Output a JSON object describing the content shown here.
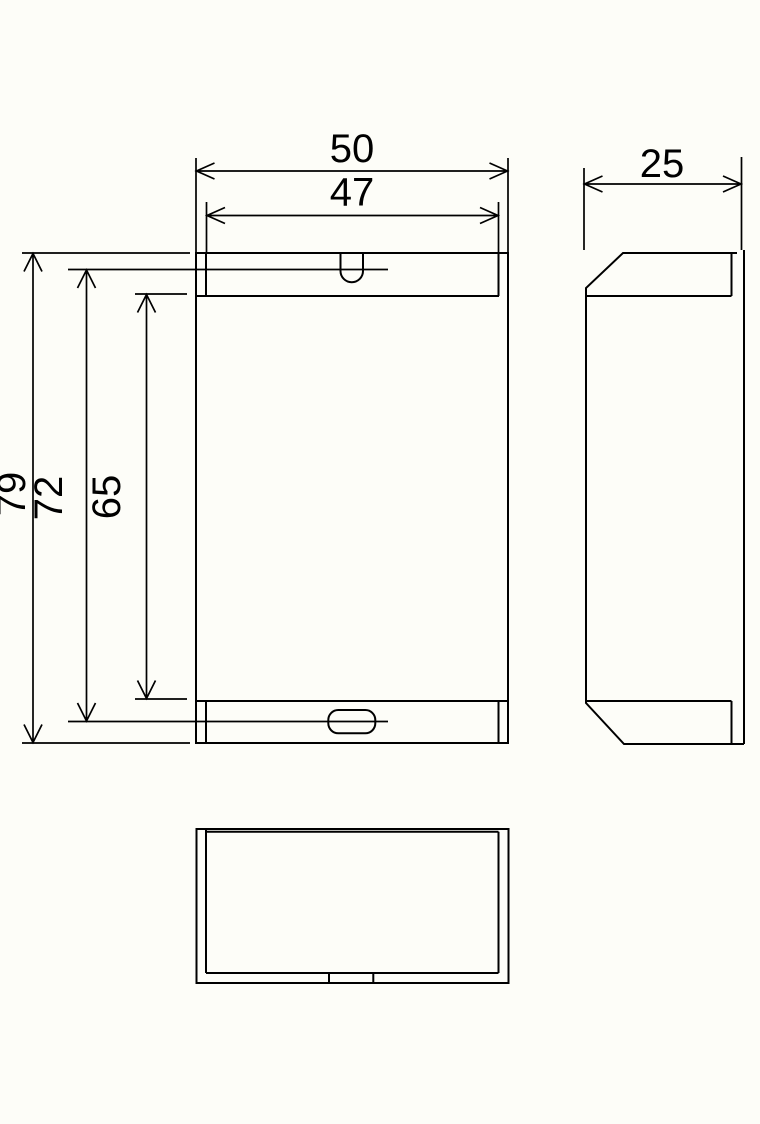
{
  "colors": {
    "background": "#fdfdf8",
    "line": "#000000",
    "text": "#000000"
  },
  "dimensions": {
    "outer_width": {
      "label": "50",
      "value": 50
    },
    "inner_width": {
      "label": "47",
      "value": 47
    },
    "depth": {
      "label": "25",
      "value": 25
    },
    "outer_height": {
      "label": "79",
      "value": 79
    },
    "mid_height": {
      "label": "72",
      "value": 72
    },
    "inner_height": {
      "label": "65",
      "value": 65
    }
  }
}
